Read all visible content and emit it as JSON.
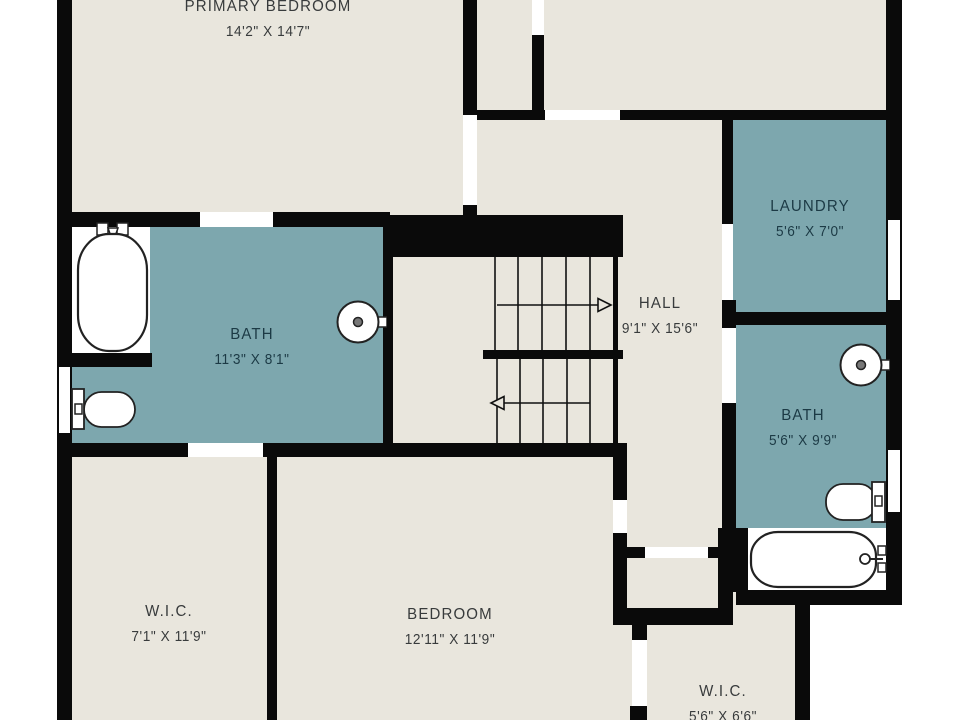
{
  "plan": {
    "type": "floor-plan",
    "rooms": {
      "primary_bedroom": {
        "name": "PRIMARY BEDROOM",
        "dimensions": "14'2\" X 14'7\""
      },
      "laundry": {
        "name": "LAUNDRY",
        "dimensions": "5'6\" X 7'0\""
      },
      "bath_left": {
        "name": "BATH",
        "dimensions": "11'3\" X 8'1\""
      },
      "hall": {
        "name": "HALL",
        "dimensions": "9'1\" X 15'6\""
      },
      "bath_right": {
        "name": "BATH",
        "dimensions": "5'6\" X 9'9\""
      },
      "wic_left": {
        "name": "W.I.C.",
        "dimensions": "7'1\" X 11'9\""
      },
      "bedroom": {
        "name": "BEDROOM",
        "dimensions": "12'11\" X 11'9\""
      },
      "wic_right": {
        "name": "W.I.C.",
        "dimensions": "5'6\" X 6'6\""
      }
    },
    "fixtures": {
      "bath_left": [
        "bathtub",
        "toilet",
        "sink"
      ],
      "bath_right": [
        "sink",
        "toilet",
        "bathtub"
      ],
      "hall": [
        "staircase-with-up-down-arrows"
      ],
      "windows_count": 3,
      "door_openings_count": 10
    },
    "colors": {
      "background": "#ffffff",
      "wall": "#0a0a0a",
      "room_fill": "#e9e6dd",
      "wet_room_fill": "#7da7ae",
      "label_dark": "#383b3c",
      "label_wet": "#1c3a45",
      "fixture_line": "#222222"
    }
  }
}
